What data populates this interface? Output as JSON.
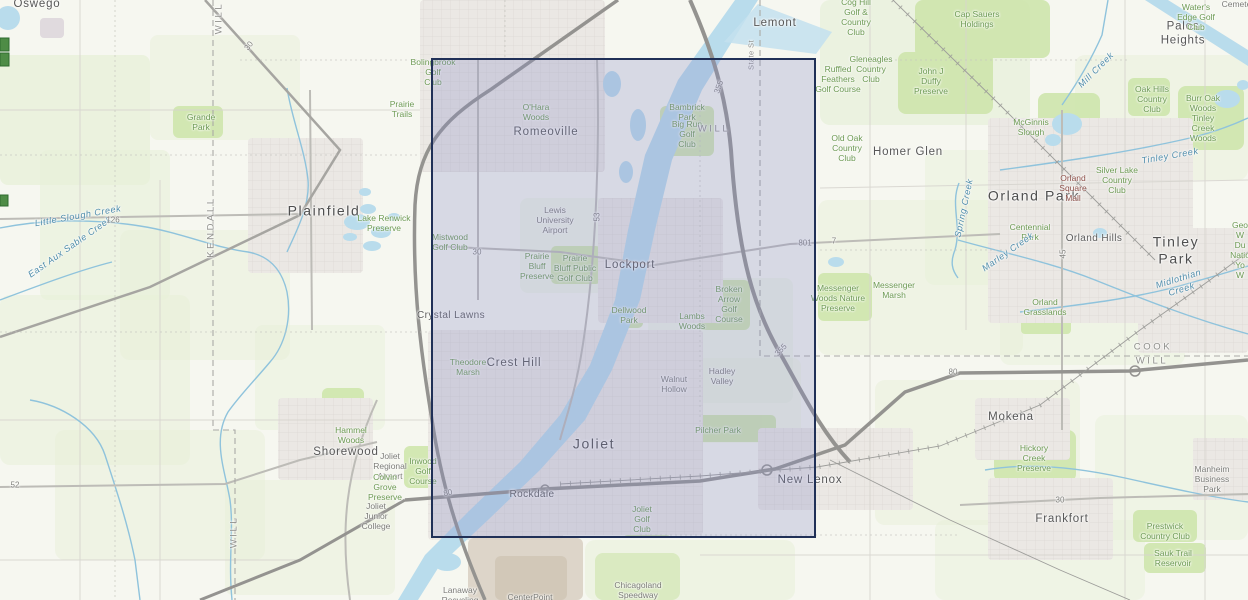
{
  "map": {
    "selection": {
      "x": 431,
      "y": 58,
      "width": 385,
      "height": 480,
      "fill": "rgba(138,140,196,0.28)",
      "border_color": "#203057",
      "border_width": 2
    },
    "palette": {
      "background": "#f6f7f0",
      "countryside_green": "#e7f0d8",
      "preserve_green": "#cfe6ae",
      "urban_gray": "#ebe8e4",
      "water_blue": "#b9dcec",
      "creek_blue": "#8fc3dc",
      "interstate_gray": "#949390",
      "road_gray": "#bdbcb7",
      "tan_industrial": "#d8cfc2",
      "selection_border": "#203057"
    },
    "labels": [
      {
        "text": "Oswego",
        "x": 37,
        "y": 5,
        "cls": "city-md"
      },
      {
        "text": "Plainfield",
        "x": 324,
        "y": 211,
        "cls": "city-lg"
      },
      {
        "text": "Romeoville",
        "x": 546,
        "y": 133,
        "cls": "city-md"
      },
      {
        "text": "Lockport",
        "x": 630,
        "y": 266,
        "cls": "city-md"
      },
      {
        "text": "Joliet",
        "x": 594,
        "y": 444,
        "cls": "city-lg"
      },
      {
        "text": "Crest Hill",
        "x": 514,
        "y": 364,
        "cls": "city-md"
      },
      {
        "text": "Crystal Lawns",
        "x": 451,
        "y": 316,
        "cls": "town"
      },
      {
        "text": "Rockdale",
        "x": 532,
        "y": 495,
        "cls": "town"
      },
      {
        "text": "Shorewood",
        "x": 346,
        "y": 453,
        "cls": "city-md"
      },
      {
        "text": "New Lenox",
        "x": 810,
        "y": 481,
        "cls": "city-md"
      },
      {
        "text": "Lemont",
        "x": 775,
        "y": 24,
        "cls": "city-md"
      },
      {
        "text": "Homer Glen",
        "x": 908,
        "y": 153,
        "cls": "city-md"
      },
      {
        "text": "Orland Park",
        "x": 1034,
        "y": 196,
        "cls": "city-lg"
      },
      {
        "text": "Orland Hills",
        "x": 1094,
        "y": 239,
        "cls": "town"
      },
      {
        "text": "Tinley Park",
        "x": 1176,
        "y": 250,
        "cls": "city-lg"
      },
      {
        "text": "Mokena",
        "x": 1011,
        "y": 418,
        "cls": "city-md"
      },
      {
        "text": "Frankfort",
        "x": 1062,
        "y": 520,
        "cls": "city-md"
      },
      {
        "text": "Palos Heights",
        "x": 1183,
        "y": 34,
        "cls": "city-md"
      },
      {
        "text": "Grande\nPark",
        "x": 201,
        "y": 122,
        "cls": "park"
      },
      {
        "text": "Prairie\nTrails",
        "x": 402,
        "y": 109,
        "cls": "park"
      },
      {
        "text": "Lake Renwick\nPreserve",
        "x": 384,
        "y": 223,
        "cls": "park"
      },
      {
        "text": "Bolingbrook\nGolf\nClub",
        "x": 433,
        "y": 72,
        "cls": "park"
      },
      {
        "text": "O'Hara\nWoods",
        "x": 536,
        "y": 112,
        "cls": "park"
      },
      {
        "text": "Bambrick\nPark",
        "x": 687,
        "y": 112,
        "cls": "park"
      },
      {
        "text": "Big Run\nGolf\nClub",
        "x": 687,
        "y": 134,
        "cls": "park"
      },
      {
        "text": "Cog Hill\nGolf &\nCountry\nClub",
        "x": 856,
        "y": 17,
        "cls": "park"
      },
      {
        "text": "Cap Sauers\nHoldings",
        "x": 977,
        "y": 19,
        "cls": "park"
      },
      {
        "text": "Gleneagles\nCountry\nClub",
        "x": 871,
        "y": 69,
        "cls": "park"
      },
      {
        "text": "Ruffled\nFeathers\nGolf Course",
        "x": 838,
        "y": 79,
        "cls": "park"
      },
      {
        "text": "John J\nDuffy\nPreserve",
        "x": 931,
        "y": 81,
        "cls": "park"
      },
      {
        "text": "Water's\nEdge Golf Club",
        "x": 1196,
        "y": 17,
        "cls": "park"
      },
      {
        "text": "Oak Hills\nCountry\nClub",
        "x": 1152,
        "y": 99,
        "cls": "park"
      },
      {
        "text": "Burr Oak\nWoods\nTinley Creek\nWoods",
        "x": 1203,
        "y": 118,
        "cls": "park"
      },
      {
        "text": "McGinnis\nSlough",
        "x": 1031,
        "y": 127,
        "cls": "park"
      },
      {
        "text": "Old Oak\nCountry\nClub",
        "x": 847,
        "y": 148,
        "cls": "park"
      },
      {
        "text": "Silver Lake\nCountry\nClub",
        "x": 1117,
        "y": 180,
        "cls": "park"
      },
      {
        "text": "Orland\nSquare\nMall",
        "x": 1073,
        "y": 188,
        "cls": "mall"
      },
      {
        "text": "Centennial\nPark",
        "x": 1030,
        "y": 232,
        "cls": "park"
      },
      {
        "text": "Messenger\nWoods Nature\nPreserve",
        "x": 838,
        "y": 298,
        "cls": "park"
      },
      {
        "text": "Messenger\nMarsh",
        "x": 894,
        "y": 290,
        "cls": "park"
      },
      {
        "text": "Orland\nGrasslands",
        "x": 1045,
        "y": 307,
        "cls": "park"
      },
      {
        "text": "Mistwood\nGolf Club",
        "x": 450,
        "y": 242,
        "cls": "park"
      },
      {
        "text": "Lewis\nUniversity\nAirport",
        "x": 555,
        "y": 220,
        "cls": "facility"
      },
      {
        "text": "Prairie\nBluff\nPreserve",
        "x": 537,
        "y": 266,
        "cls": "park"
      },
      {
        "text": "Prairie\nBluff Public\nGolf Club",
        "x": 575,
        "y": 268,
        "cls": "park"
      },
      {
        "text": "Dellwood\nPark",
        "x": 629,
        "y": 315,
        "cls": "park"
      },
      {
        "text": "Lambs\nWoods",
        "x": 692,
        "y": 321,
        "cls": "park"
      },
      {
        "text": "Broken\nArrow\nGolf\nCourse",
        "x": 729,
        "y": 304,
        "cls": "park"
      },
      {
        "text": "Theodore\nMarsh",
        "x": 468,
        "y": 367,
        "cls": "park"
      },
      {
        "text": "Walnut\nHollow",
        "x": 674,
        "y": 384,
        "cls": "facility"
      },
      {
        "text": "Hadley\nValley",
        "x": 722,
        "y": 376,
        "cls": "facility"
      },
      {
        "text": "Pilcher Park",
        "x": 718,
        "y": 430,
        "cls": "park"
      },
      {
        "text": "Inwood\nGolf\nCourse",
        "x": 423,
        "y": 471,
        "cls": "park"
      },
      {
        "text": "Hammel\nWoods",
        "x": 351,
        "y": 435,
        "cls": "park"
      },
      {
        "text": "Joliet\nRegional\nAirport",
        "x": 390,
        "y": 466,
        "cls": "facility"
      },
      {
        "text": "Colvin\nGrove\nPreserve",
        "x": 385,
        "y": 487,
        "cls": "park"
      },
      {
        "text": "Joliet\nJunior\nCollege",
        "x": 376,
        "y": 516,
        "cls": "facility"
      },
      {
        "text": "Joliet\nGolf\nClub",
        "x": 642,
        "y": 519,
        "cls": "park"
      },
      {
        "text": "Hickory\nCreek\nPreserve",
        "x": 1034,
        "y": 458,
        "cls": "park"
      },
      {
        "text": "Manheim\nBusiness\nPark",
        "x": 1212,
        "y": 479,
        "cls": "facility"
      },
      {
        "text": "Prestwick\nCountry Club",
        "x": 1165,
        "y": 531,
        "cls": "park"
      },
      {
        "text": "Sauk Trail\nReservoir",
        "x": 1173,
        "y": 558,
        "cls": "park"
      },
      {
        "text": "Chicagoland\nSpeedway",
        "x": 638,
        "y": 590,
        "cls": "facility"
      },
      {
        "text": "CenterPoint",
        "x": 530,
        "y": 597,
        "cls": "facility"
      },
      {
        "text": "Lanaway\nRecycling",
        "x": 460,
        "y": 595,
        "cls": "facility"
      },
      {
        "text": "Geo\nW Du\nNatio\nYo\nW",
        "x": 1240,
        "y": 250,
        "cls": "park"
      },
      {
        "text": "Cemetery",
        "x": 1240,
        "y": 4,
        "cls": "facility"
      },
      {
        "text": "Little Slough Creek",
        "x": 78,
        "y": 216,
        "cls": "water",
        "rot": -10
      },
      {
        "text": "East Aux Sable Creek",
        "x": 70,
        "y": 247,
        "cls": "water",
        "rot": -35
      },
      {
        "text": "Mill Creek",
        "x": 1096,
        "y": 70,
        "cls": "water",
        "rot": -45
      },
      {
        "text": "Tinley Creek",
        "x": 1170,
        "y": 156,
        "cls": "water",
        "rot": -10
      },
      {
        "text": "Midlothian Creek",
        "x": 1180,
        "y": 284,
        "cls": "water",
        "rot": -17
      },
      {
        "text": "Spring Creek",
        "x": 964,
        "y": 208,
        "cls": "water",
        "rot": -78
      },
      {
        "text": "Marley Creek",
        "x": 1008,
        "y": 252,
        "cls": "water",
        "rot": -35
      },
      {
        "text": "WILL",
        "x": 219,
        "y": 18,
        "cls": "county",
        "rot": -90
      },
      {
        "text": "KENDALL",
        "x": 211,
        "y": 227,
        "cls": "county",
        "rot": -90
      },
      {
        "text": "WILL",
        "x": 234,
        "y": 532,
        "cls": "county",
        "rot": -90
      },
      {
        "text": "WILL",
        "x": 714,
        "y": 129,
        "cls": "county"
      },
      {
        "text": "COOK",
        "x": 1153,
        "y": 347,
        "cls": "county"
      },
      {
        "text": "WILL",
        "x": 1152,
        "y": 361,
        "cls": "county"
      },
      {
        "text": "State St",
        "x": 752,
        "y": 55,
        "cls": "street",
        "rot": -90
      },
      {
        "text": "126",
        "x": 113,
        "y": 220,
        "cls": "route"
      },
      {
        "text": "30",
        "x": 249,
        "y": 46,
        "cls": "route",
        "rot": -52
      },
      {
        "text": "30",
        "x": 477,
        "y": 252,
        "cls": "route"
      },
      {
        "text": "30",
        "x": 1060,
        "y": 500,
        "cls": "route"
      },
      {
        "text": "52",
        "x": 15,
        "y": 485,
        "cls": "route"
      },
      {
        "text": "53",
        "x": 597,
        "y": 217,
        "cls": "route",
        "rot": -90
      },
      {
        "text": "45",
        "x": 1063,
        "y": 254,
        "cls": "route",
        "rot": -90
      },
      {
        "text": "355",
        "x": 719,
        "y": 87,
        "cls": "route",
        "rot": -70
      },
      {
        "text": "355",
        "x": 781,
        "y": 350,
        "cls": "route",
        "rot": -45
      },
      {
        "text": "801",
        "x": 805,
        "y": 243,
        "cls": "route"
      },
      {
        "text": "7",
        "x": 834,
        "y": 241,
        "cls": "route"
      },
      {
        "text": "80",
        "x": 448,
        "y": 493,
        "cls": "route",
        "rot": -14
      },
      {
        "text": "80",
        "x": 953,
        "y": 372,
        "cls": "route"
      }
    ]
  }
}
